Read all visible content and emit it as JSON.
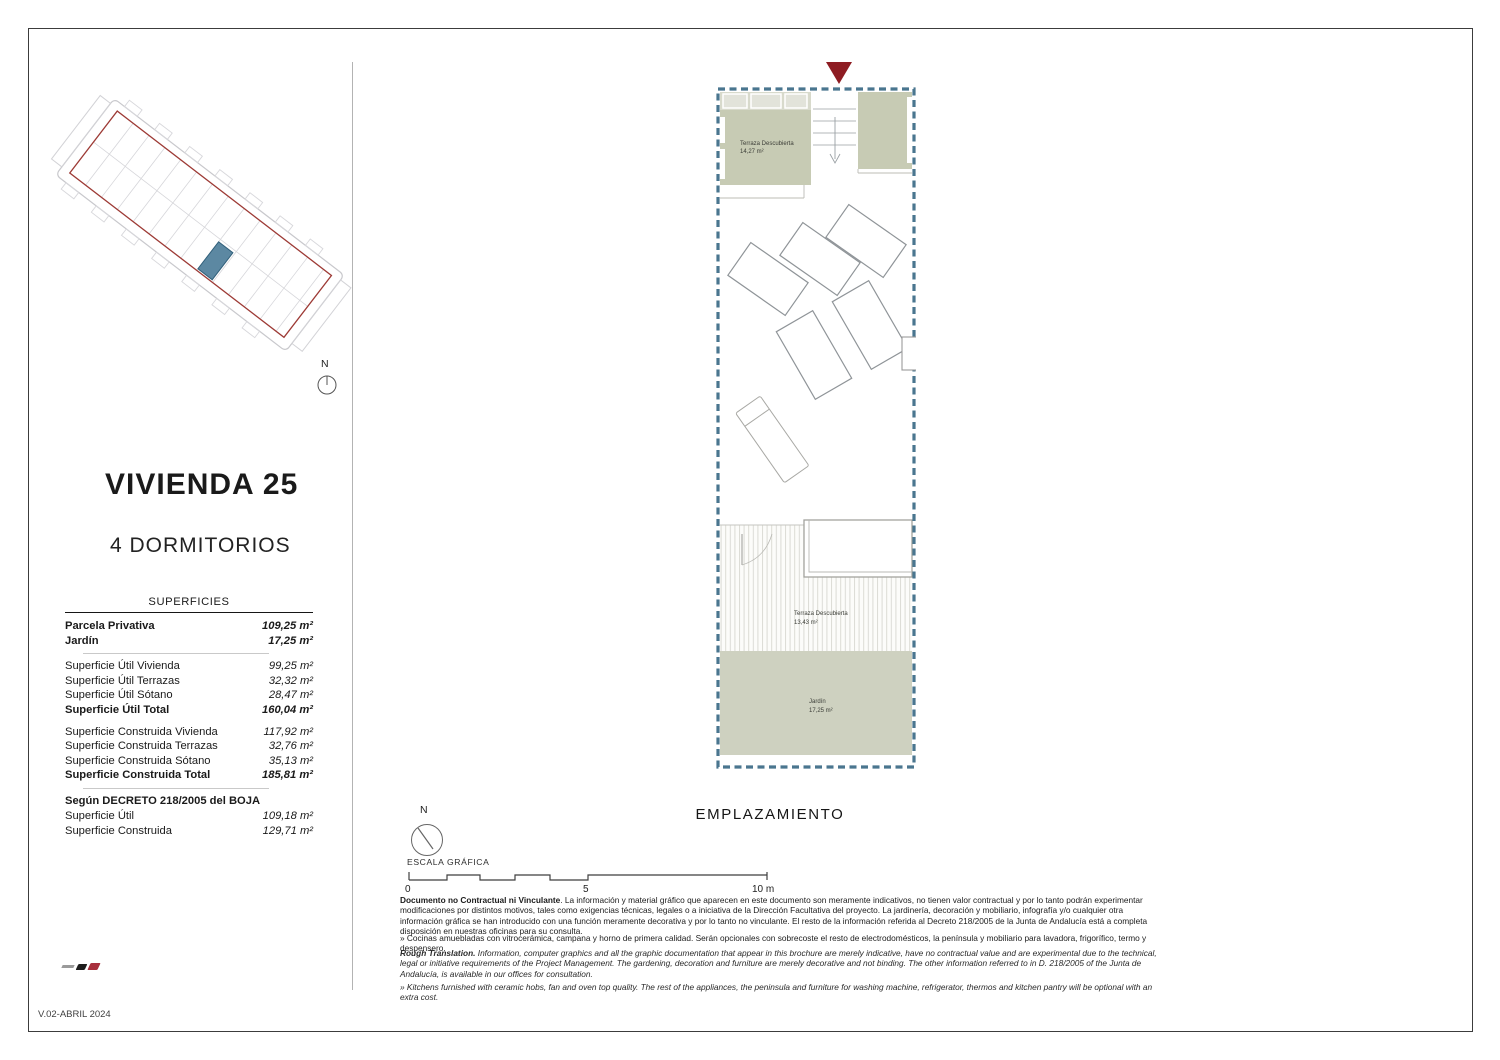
{
  "left_panel": {
    "title": "VIVIENDA 25",
    "subtitle": "4 DORMITORIOS",
    "table": {
      "header": "SUPERFICIES",
      "parcela": {
        "label": "Parcela Privativa",
        "value": "109,25 m²"
      },
      "jardin": {
        "label": "Jardín",
        "value": "17,25 m²"
      },
      "util": [
        {
          "label": "Superficie Útil Vivienda",
          "value": "99,25 m²"
        },
        {
          "label": "Superficie Útil Terrazas",
          "value": "32,32 m²"
        },
        {
          "label": "Superficie Útil Sótano",
          "value": "28,47 m²"
        },
        {
          "label": "Superficie Útil Total",
          "value": "160,04 m²"
        }
      ],
      "construida": [
        {
          "label": "Superficie Construida Vivienda",
          "value": "117,92 m²"
        },
        {
          "label": "Superficie Construida Terrazas",
          "value": "32,76 m²"
        },
        {
          "label": "Superficie Construida Sótano",
          "value": "35,13 m²"
        },
        {
          "label": "Superficie Construida Total",
          "value": "185,81 m²"
        }
      ],
      "decreto": {
        "heading": "Según DECRETO 218/2005 del BOJA",
        "rows": [
          {
            "label": "Superficie Útil",
            "value": "109,18 m²"
          },
          {
            "label": "Superficie Construida",
            "value": "129,71 m²"
          }
        ]
      }
    }
  },
  "site_plan": {
    "north_label": "N"
  },
  "plan": {
    "terrace_top": {
      "name": "Terraza Descubierta",
      "area": "14,27 m²"
    },
    "terrace_bottom": {
      "name": "Terraza Descubierta",
      "area": "13,43 m²"
    },
    "garden": {
      "name": "Jardín",
      "area": "17,25 m²"
    }
  },
  "footer": {
    "emplazamiento": "EMPLAZAMIENTO",
    "escala_label": "ESCALA GRÁFICA",
    "north_label": "N",
    "scale_ticks": [
      "0",
      "5",
      "10 m"
    ],
    "legal_es_bold": "Documento no Contractual ni Vinculante",
    "legal_es_text": ". La información y material gráfico que aparecen en este documento son meramente indicativos, no tienen valor contractual y por lo tanto podrán experimentar modificaciones por distintos motivos, tales como exigencias técnicas, legales o a iniciativa de la Dirección Facultativa del proyecto. La jardinería, decoración y mobiliario, infografía y/o cualquier otra información gráfica se han introducido con una función meramente decorativa y por lo tanto no vinculante. El resto de la información referida al Decreto 218/2005 de la Junta de Andalucía está a completa disposición en nuestras oficinas para su consulta.",
    "bullet_es": "» Cocinas amuebladas con vitrocerámica, campana y horno de primera calidad. Serán opcionales con sobrecoste el resto de electrodomésticos, la península y mobiliario para lavadora, frigorífico, termo y despensero.",
    "legal_en_bold": "Rough Translation.",
    "legal_en_text": " Information, computer graphics and all the graphic documentation that appear in this brochure are merely indicative, have no contractual value and are experimental due to the technical, legal or initiative requirements of the Project Management. The gardening, decoration and furniture are merely decorative and not binding. The other information referred to in D. 218/2005 of the Junta de Andalucía, is available in our offices for consultation.",
    "bullet_en": "» Kitchens furnished with ceramic hobs, fan and oven top quality. The rest of the appliances, the peninsula and furniture for washing machine, refrigerator, thermos and kitchen pantry will be optional with an extra cost.",
    "version": "V.02-ABRIL 2024"
  },
  "colors": {
    "plan_border_blue": "#4a768f",
    "terrace_green": "#c7cbb4",
    "garden_green": "#ced1c0",
    "boundary_red": "#9d3a35",
    "unit_blue": "#5c88a2",
    "entrance_marker_red": "#8e1c22"
  }
}
